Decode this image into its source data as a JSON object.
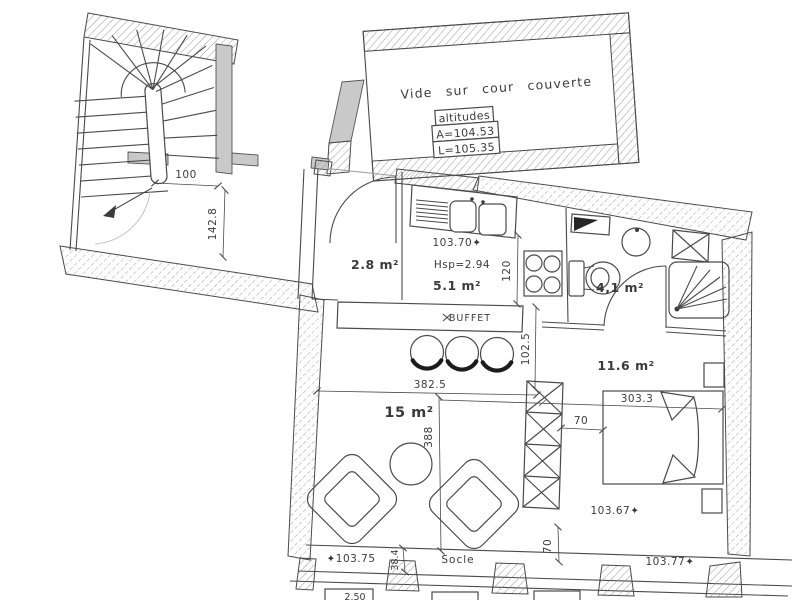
{
  "drawing": {
    "upper_room": {
      "label": "Vide sur cour couverte",
      "altitudes_table": {
        "header": "altitudes",
        "row_a": "A=104.53",
        "row_l": "L=105.35"
      }
    },
    "rooms": {
      "entry": {
        "area": "2.8 m²"
      },
      "kitchen": {
        "area": "5.1 m²",
        "ceiling_height": "Hsp=2.94",
        "floor_level": "103.70✦"
      },
      "bathroom": {
        "area": "4,1 m²"
      },
      "living": {
        "area": "15 m²"
      },
      "bedroom": {
        "area": "11.6 m²",
        "floor_level": "103.67✦"
      }
    },
    "furniture": {
      "buffet_label": "BUFFET"
    },
    "base": {
      "socle_label": "Socle",
      "level_left": "✦103.75",
      "level_right": "103.77✦",
      "partial_note": "2.50"
    },
    "dimensions": {
      "stair_width": "100",
      "landing_depth": "142.8",
      "kitchen_depth": "120",
      "buffet_to_column": "102.5",
      "living_width": "382.5",
      "living_depth": "388",
      "bedroom_width": "303.3",
      "column_to_bed": "70",
      "column_to_base": "70",
      "socle_height": "38.4"
    },
    "colors": {
      "wall_gray": "#c9c9c9",
      "line": "#4a4a4a",
      "hatch": "#8f8f8f"
    }
  }
}
